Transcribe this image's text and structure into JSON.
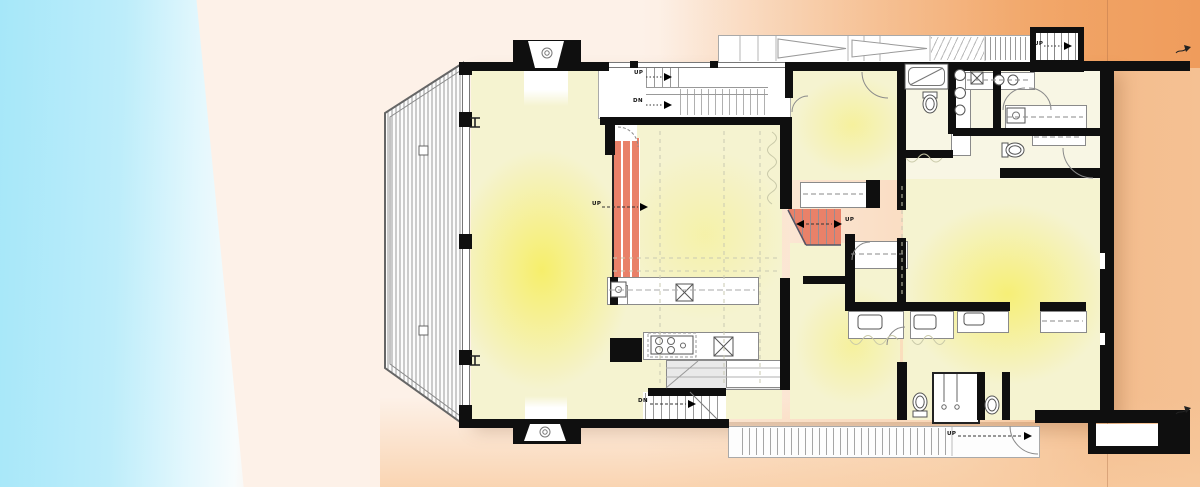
{
  "plan": {
    "title": "residential floor plan",
    "labels": [
      {
        "id": "upper-stair-up",
        "text": "UP"
      },
      {
        "id": "upper-stair-down",
        "text": "DN"
      },
      {
        "id": "living-stair-up",
        "text": "UP"
      },
      {
        "id": "mid-stair-up",
        "text": "UP"
      },
      {
        "id": "top-right-stair-up",
        "text": "UP"
      },
      {
        "id": "bottom-stair-up",
        "text": "UP"
      },
      {
        "id": "lower-stair-down",
        "text": "DN"
      }
    ],
    "colors": {
      "sky_gradient_left": "#a6e7f9",
      "background_cream": "#fdf1e8",
      "background_orange": "#f4bd8e",
      "background_orange_deep": "#f0a164",
      "room_yellow": "#f5f3d0",
      "room_glow_yellow": "#f6ee71",
      "stair_accent_red": "#e98169",
      "wall_black": "#0f0f0f",
      "deck_hatch_grey": "#9a9a9a"
    }
  }
}
